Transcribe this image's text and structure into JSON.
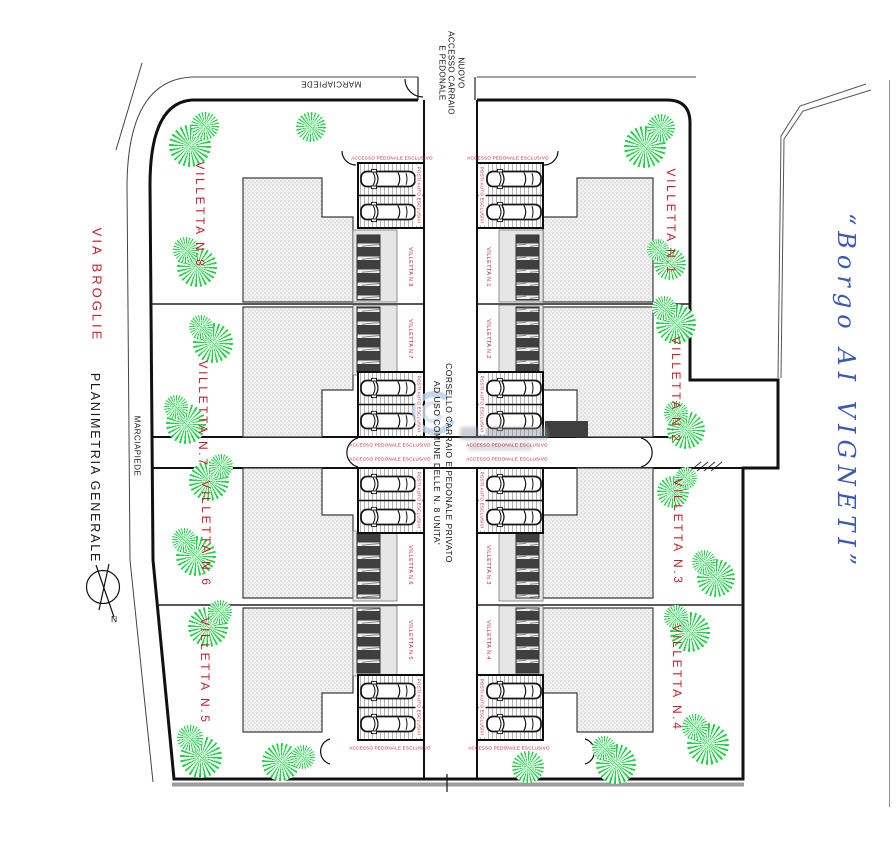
{
  "plan": {
    "title": "PLANIMETRIA GENERALE",
    "street_label": "VIA BROGLIE",
    "project_name": "“Borgo AI VIGNETI”",
    "north_label": "N",
    "sidewalk_top": "MARCIAPIEDE",
    "sidewalk_left": "MARCIAPIEDE",
    "access_line1": "NUOVO",
    "access_line2": "ACCESSO CARRAIO",
    "access_line3": "E PEDONALE",
    "corsello_line1": "CORSELLO CARRAIO E PEDONALE PRIVATO",
    "corsello_line2": "AD USO COMUNE DELLE N. 8 UNITA'",
    "pedestrian_access_label": "ACCESSO PEDONALE ESCLUSIVO",
    "parking_label": "POSTI AUTO ESCLUSIVI"
  },
  "villas": [
    {
      "label": "VILLETTA N.1"
    },
    {
      "label": "VILLETTA N.2"
    },
    {
      "label": "VILLETTA N.3"
    },
    {
      "label": "VILLETTA N.4"
    },
    {
      "label": "VILLETTA N.5"
    },
    {
      "label": "VILLETTA N.6"
    },
    {
      "label": "VILLETTA N.7"
    },
    {
      "label": "VILLETTA N.8"
    }
  ],
  "colors": {
    "red": "#c51f2e",
    "green": "#12d43c",
    "blue": "#3a58bb",
    "building": "#f1f1f1",
    "dark": "#3f3f3f"
  }
}
